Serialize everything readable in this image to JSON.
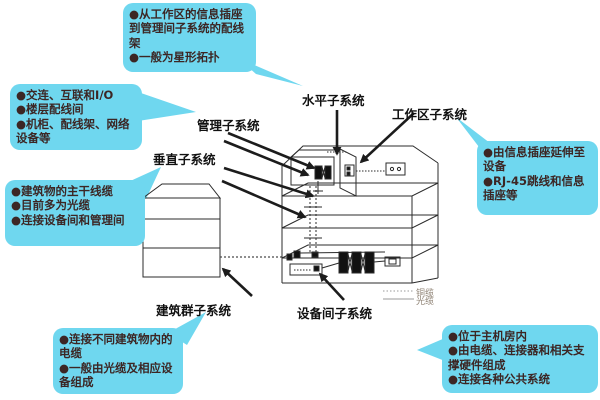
{
  "diagram": {
    "subject": "structured-cabling-subsystems",
    "colors": {
      "callout_bg": "#6fd7ef",
      "callout_text": "#3c2624",
      "label_text": "#111111",
      "line": "#2b2b2b",
      "legend_text": "#8f8375"
    },
    "callouts": [
      {
        "target": "horizontal-subsystem",
        "items": [
          "●从工作区的信息插座到管理间子系统的配线架",
          "●一般为星形拓扑"
        ]
      },
      {
        "target": "management-subsystem",
        "items": [
          "●交连、互联和I/O",
          "●楼层配线间",
          "●机柜、配线架、网络设备等"
        ]
      },
      {
        "target": "vertical-subsystem",
        "items": [
          "●建筑物的主干线缆",
          "●目前多为光缆",
          "●连接设备间和管理间"
        ]
      },
      {
        "target": "campus-subsystem",
        "items": [
          "●连接不同建筑物内的电缆",
          "●一般由光缆及相应设备组成"
        ]
      },
      {
        "target": "workarea-subsystem",
        "items": [
          "●由信息插座延伸至设备",
          "●RJ-45跳线和信息插座等"
        ]
      },
      {
        "target": "equipment-room-subsystem",
        "items": [
          "●位于主机房内",
          "●由电缆、连接器和相关支撑硬件组成",
          "●连接各种公共系统"
        ]
      }
    ],
    "labels": {
      "horizontal": "水平子系统",
      "workarea": "工作区子系统",
      "management": "管理子系统",
      "vertical": "垂直子系统",
      "campus": "建筑群子系统",
      "equipment": "设备间子系统"
    },
    "legend": {
      "copper": "铜缆",
      "fiber": "光缆"
    }
  }
}
